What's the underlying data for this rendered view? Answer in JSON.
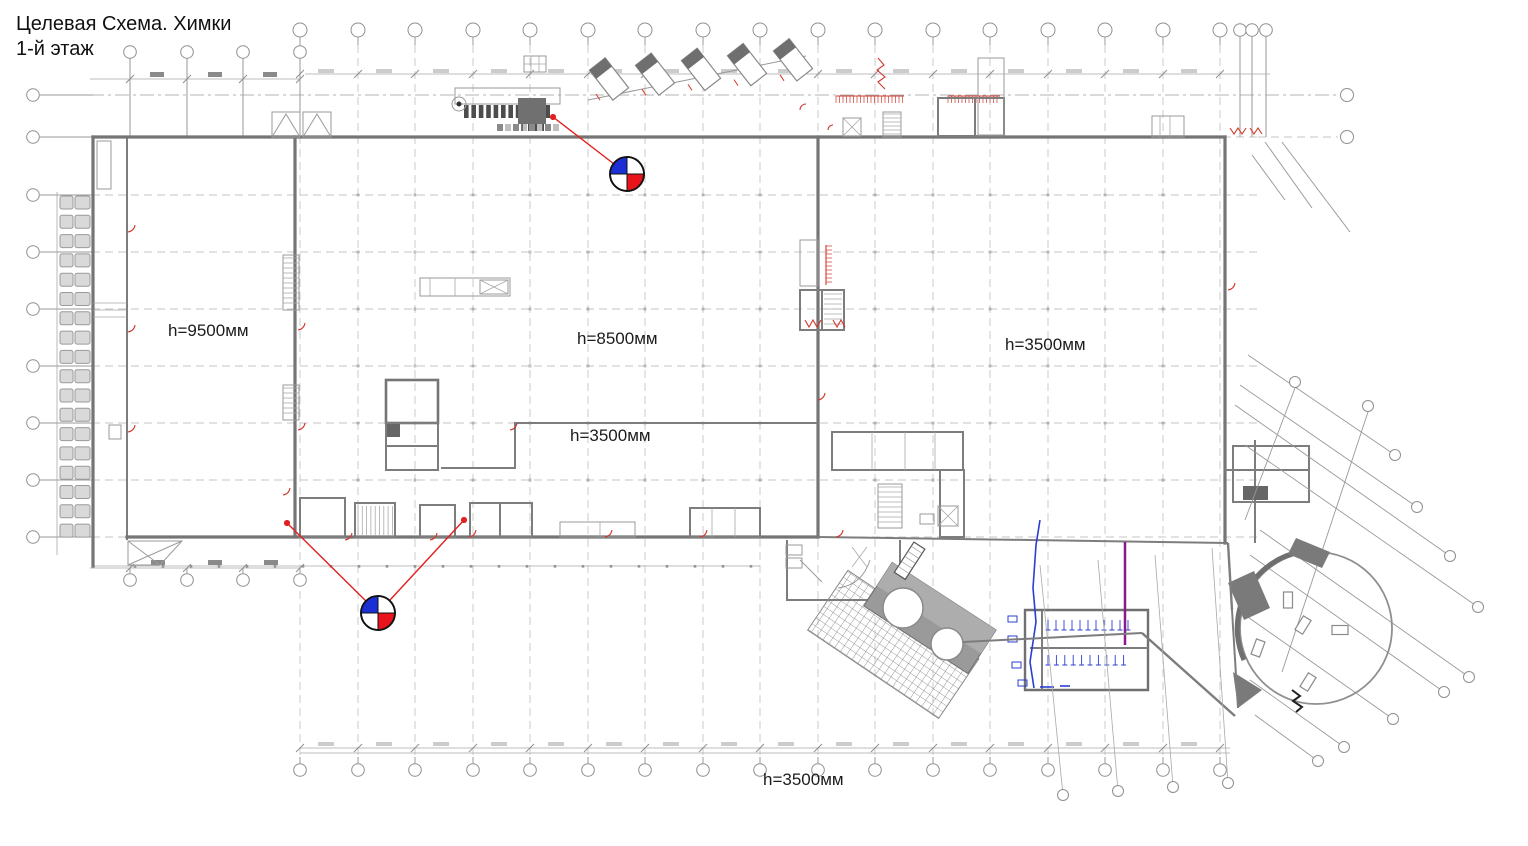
{
  "title": {
    "line1": "Целевая Схема. Химки",
    "line2": "1-й этаж"
  },
  "labels": {
    "height_labels": [
      {
        "text": "h=9500мм"
      },
      {
        "text": "h=8500мм"
      },
      {
        "text": "h=3500мм"
      },
      {
        "text": "h=3500мм"
      },
      {
        "text": "h=3500мм"
      }
    ]
  },
  "markers": [
    {
      "name": "survey-marker-top",
      "cx": 627,
      "cy": 174,
      "r": 17,
      "leaders": [
        {
          "x1": 553,
          "y1": 117
        }
      ]
    },
    {
      "name": "survey-marker-bottom",
      "cx": 378,
      "cy": 613,
      "r": 17,
      "leaders": [
        {
          "x1": 287,
          "y1": 523
        },
        {
          "x1": 464,
          "y1": 520
        }
      ]
    }
  ],
  "colors": {
    "marker_blue": "#1b2fd4",
    "marker_red": "#e8131b",
    "leader_red": "#e02020",
    "detail_red": "#d2382c",
    "wall_gray": "#757575",
    "wall_dark": "#6f6f6f",
    "grid_gray": "#c6c6c6",
    "fill_gray": "#9a9a9a",
    "plumbing_blue": "#2a3fd0",
    "utility_purple": "#8a1a8a"
  }
}
